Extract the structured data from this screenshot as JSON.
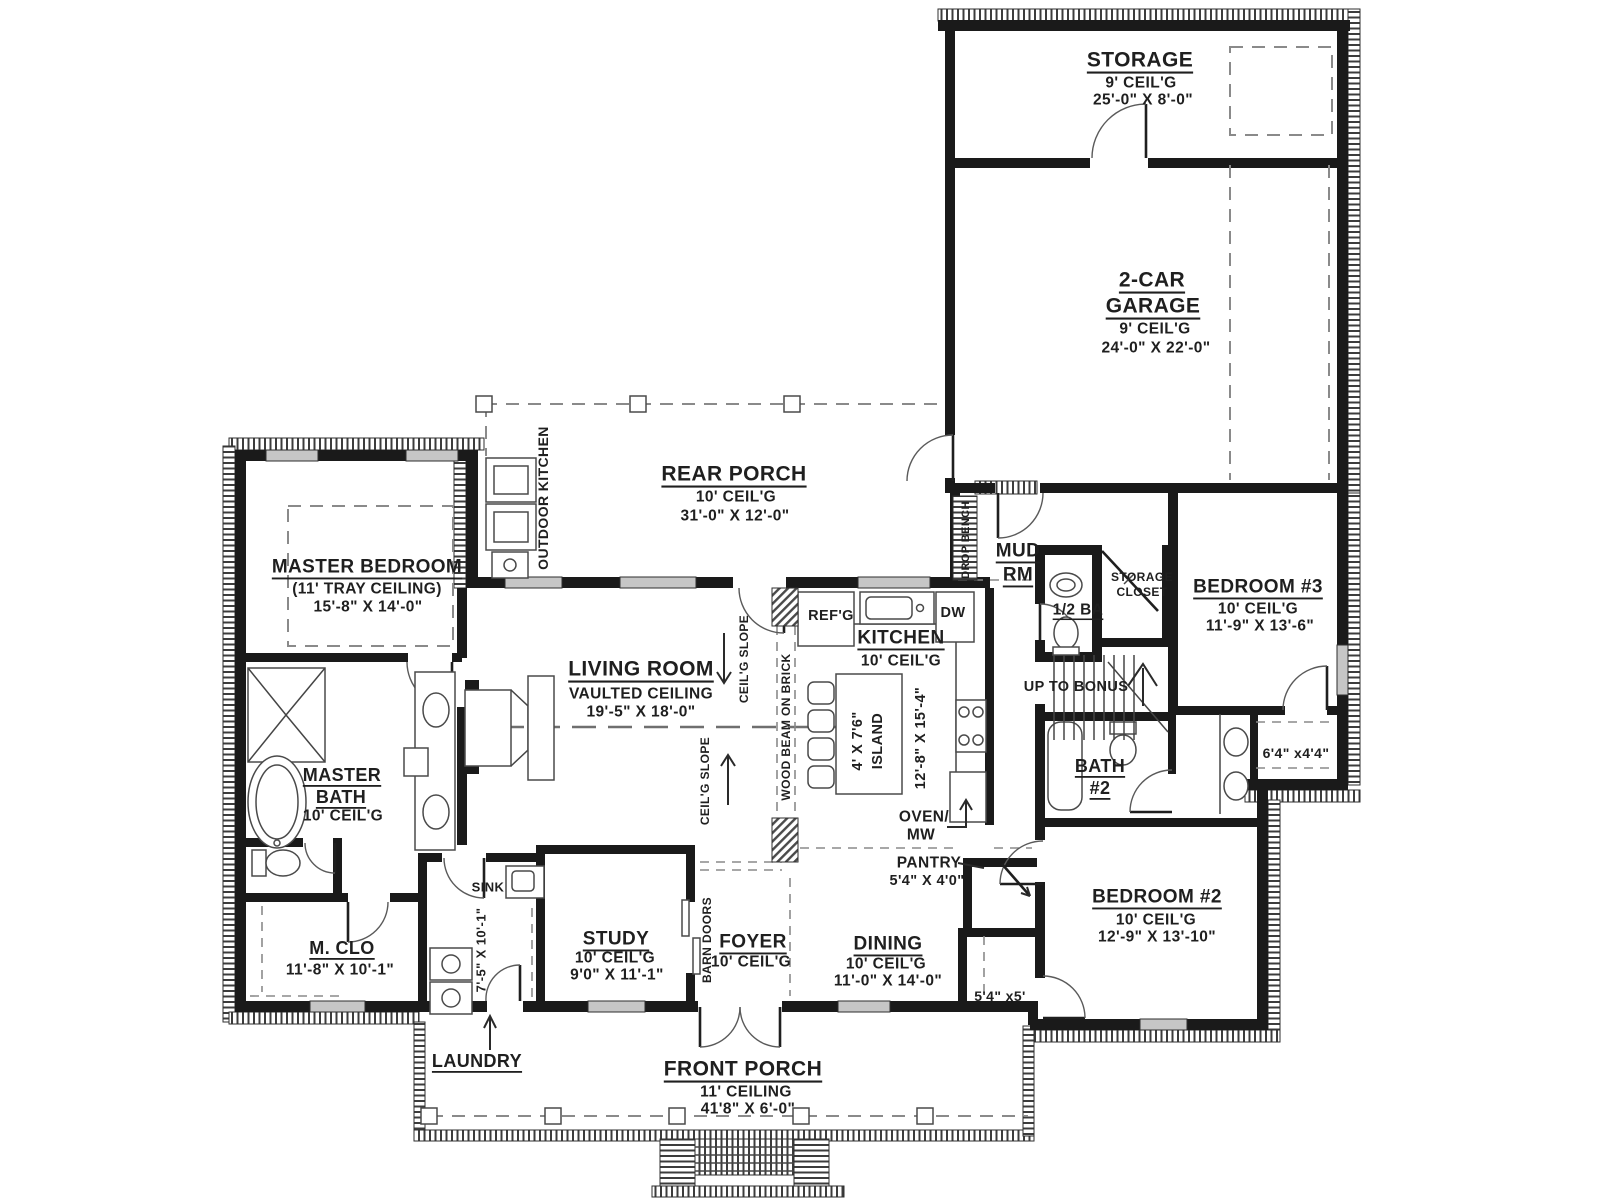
{
  "plan": {
    "rooms": {
      "storage": {
        "title": "STORAGE",
        "ceil": "9' CEIL'G",
        "dims": "25'-0\" X 8'-0\""
      },
      "garage": {
        "t1": "2-CAR",
        "t2": "GARAGE",
        "ceil": "9' CEIL'G",
        "dims": "24'-0\" X 22'-0\""
      },
      "rear_porch": {
        "title": "REAR PORCH",
        "ceil": "10' CEIL'G",
        "dims": "31'-0\" X 12'-0\""
      },
      "master_bedroom": {
        "title": "MASTER BEDROOM",
        "ceil": "(11' TRAY CEILING)",
        "dims": "15'-8\" X 14'-0\""
      },
      "living_room": {
        "title": "LIVING ROOM",
        "ceil": "VAULTED CEILING",
        "dims": "19'-5\" X 18'-0\""
      },
      "kitchen": {
        "title": "KITCHEN",
        "ceil": "10' CEIL'G",
        "dims": "12'-8\" X 15'-4\"",
        "island_l1": "4' X 7'6\"",
        "island_l2": "ISLAND"
      },
      "mud_room": {
        "t1": "MUD",
        "t2": "RM"
      },
      "half_bath": {
        "title": "1/2 BA"
      },
      "storage_closet": {
        "t1": "STORAGE",
        "t2": "CLOSET"
      },
      "stairs": {
        "note": "UP TO BONUS"
      },
      "bedroom3": {
        "title": "BEDROOM #3",
        "ceil": "10' CEIL'G",
        "dims": "11'-9\" X 13'-6\""
      },
      "closet_bedroom3": {
        "dims": "6'4\" x4'4\""
      },
      "bath2": {
        "t1": "BATH",
        "t2": "#2"
      },
      "bedroom2": {
        "title": "BEDROOM #2",
        "ceil": "10' CEIL'G",
        "dims": "12'-9\" X 13'-10\""
      },
      "closet_bedroom2": {
        "dims": "5'4\" x5'"
      },
      "master_bath": {
        "t1": "MASTER",
        "t2": "BATH",
        "ceil": "10' CEIL'G"
      },
      "master_closet": {
        "title": "M. CLO",
        "dims": "11'-8\" X 10'-1\""
      },
      "laundry": {
        "title": "LAUNDRY",
        "dims": "7'-5\" X 10'-1\""
      },
      "study": {
        "title": "STUDY",
        "ceil": "10' CEIL'G",
        "dims": "9'0\" X 11'-1\""
      },
      "foyer": {
        "title": "FOYER",
        "ceil": "10' CEIL'G"
      },
      "dining": {
        "title": "DINING",
        "ceil": "10' CEIL'G",
        "dims": "11'-0\" X 14'-0\""
      },
      "pantry": {
        "title": "PANTRY",
        "dims": "5'4\" X 4'0\""
      },
      "front_porch": {
        "title": "FRONT PORCH",
        "ceil": "11' CEILING",
        "dims": "41'8\" X 6'-0\""
      }
    },
    "annotations": {
      "outdoor_kitchen": "OUTDOOR KITCHEN",
      "drop_bench": "DROP BENCH",
      "wood_beam": "WOOD BEAM ON BRICK",
      "ceiling_slope": "CEIL'G SLOPE",
      "refg": "REF'G",
      "dw": "DW",
      "oven_l1": "OVEN/",
      "oven_l2": "MW",
      "sink": "SINK",
      "barn_doors": "BARN DOORS"
    },
    "colors": {
      "wall": "#1a1a1a",
      "hatch": "#3c3c3c",
      "dashed": "#8a8a8a",
      "window": "#c6c6c6",
      "text": "#1f1f1f",
      "bg": "#ffffff"
    }
  }
}
